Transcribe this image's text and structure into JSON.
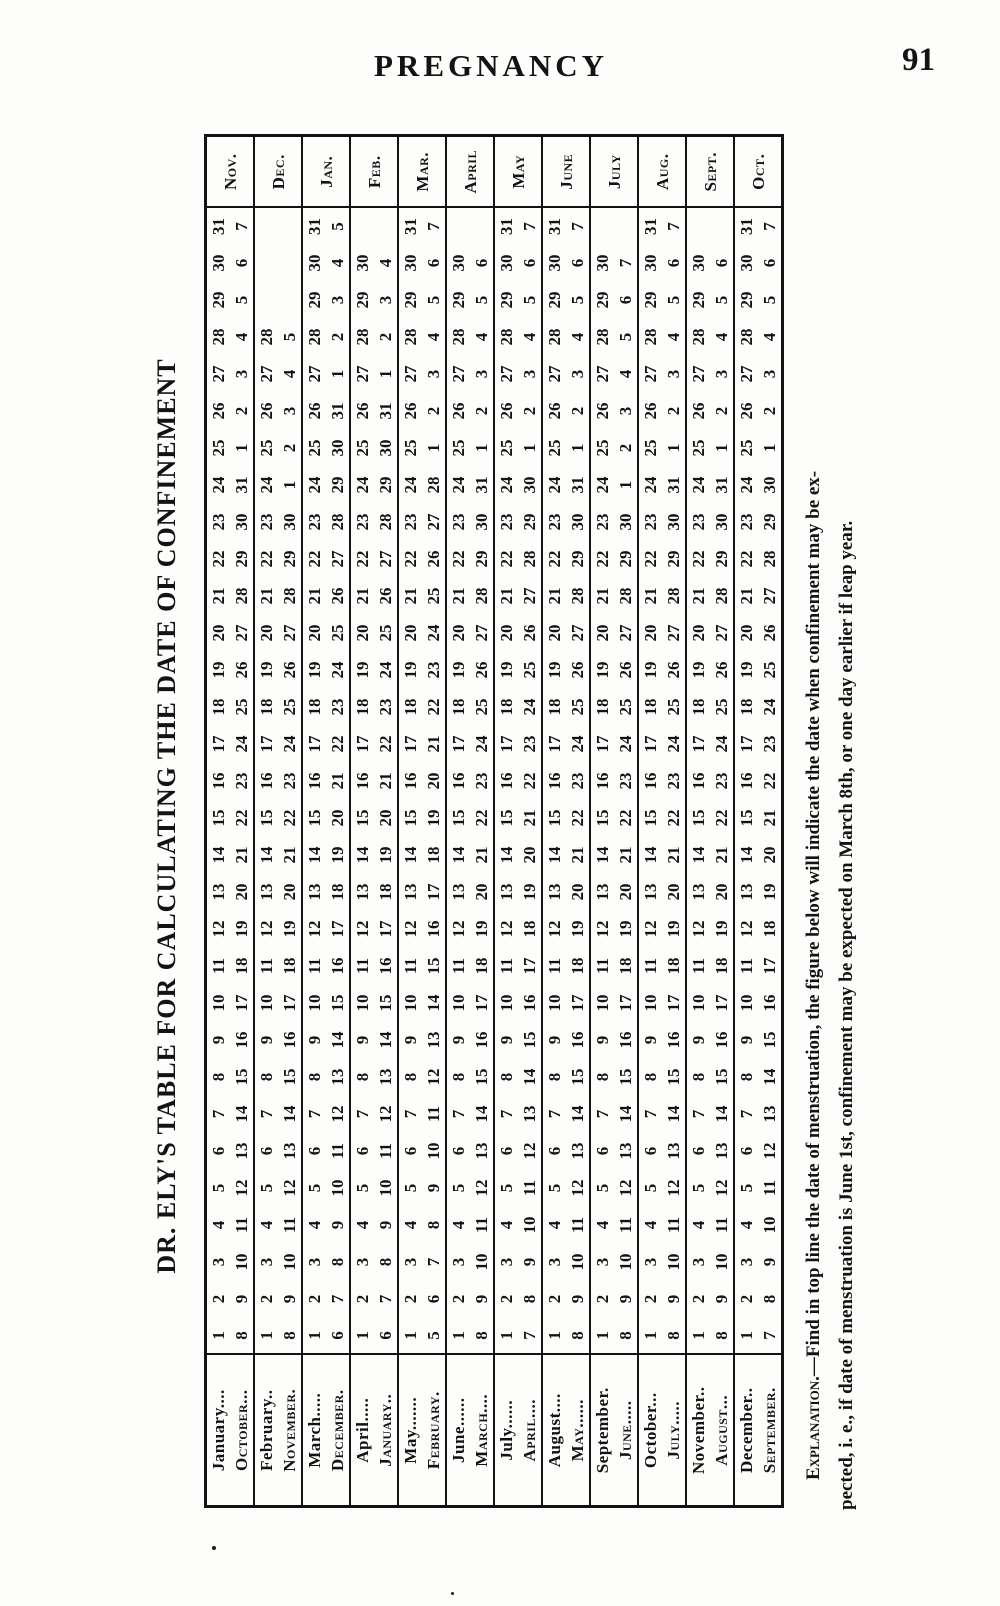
{
  "page": {
    "header_title": "PREGNANCY",
    "page_number": "91"
  },
  "colors": {
    "ink": "#131313",
    "paper": "#fdfdfb"
  },
  "table": {
    "title": "DR. ELY'S TABLE FOR CALCULATING THE DATE OF CONFINEMENT",
    "rows": [
      {
        "menses_month": "January....",
        "confine_month": "October...",
        "overflow_label": "Nov.",
        "menses_days": [
          1,
          2,
          3,
          4,
          5,
          6,
          7,
          8,
          9,
          10,
          11,
          12,
          13,
          14,
          15,
          16,
          17,
          18,
          19,
          20,
          21,
          22,
          23,
          24,
          25,
          26,
          27,
          28,
          29,
          30,
          31
        ],
        "confine_dates": [
          8,
          9,
          10,
          11,
          12,
          13,
          14,
          15,
          16,
          17,
          18,
          19,
          20,
          21,
          22,
          23,
          24,
          25,
          26,
          27,
          28,
          29,
          30,
          31,
          1,
          2,
          3,
          4,
          5,
          6,
          7
        ]
      },
      {
        "menses_month": "February..",
        "confine_month": "November.",
        "overflow_label": "Dec.",
        "menses_days": [
          1,
          2,
          3,
          4,
          5,
          6,
          7,
          8,
          9,
          10,
          11,
          12,
          13,
          14,
          15,
          16,
          17,
          18,
          19,
          20,
          21,
          22,
          23,
          24,
          25,
          26,
          27,
          28
        ],
        "confine_dates": [
          8,
          9,
          10,
          11,
          12,
          13,
          14,
          15,
          16,
          17,
          18,
          19,
          20,
          21,
          22,
          23,
          24,
          25,
          26,
          27,
          28,
          29,
          30,
          1,
          2,
          3,
          4,
          5
        ]
      },
      {
        "menses_month": "March.....",
        "confine_month": "December.",
        "overflow_label": "Jan.",
        "menses_days": [
          1,
          2,
          3,
          4,
          5,
          6,
          7,
          8,
          9,
          10,
          11,
          12,
          13,
          14,
          15,
          16,
          17,
          18,
          19,
          20,
          21,
          22,
          23,
          24,
          25,
          26,
          27,
          28,
          29,
          30,
          31
        ],
        "confine_dates": [
          6,
          7,
          8,
          9,
          10,
          11,
          12,
          13,
          14,
          15,
          16,
          17,
          18,
          19,
          20,
          21,
          22,
          23,
          24,
          25,
          26,
          27,
          28,
          29,
          30,
          31,
          1,
          2,
          3,
          4,
          5
        ]
      },
      {
        "menses_month": "April.....",
        "confine_month": "January..",
        "overflow_label": "Feb.",
        "menses_days": [
          1,
          2,
          3,
          4,
          5,
          6,
          7,
          8,
          9,
          10,
          11,
          12,
          13,
          14,
          15,
          16,
          17,
          18,
          19,
          20,
          21,
          22,
          23,
          24,
          25,
          26,
          27,
          28,
          29,
          30
        ],
        "confine_dates": [
          6,
          7,
          8,
          9,
          10,
          11,
          12,
          13,
          14,
          15,
          16,
          17,
          18,
          19,
          20,
          21,
          22,
          23,
          24,
          25,
          26,
          27,
          28,
          29,
          30,
          31,
          1,
          2,
          3,
          4
        ]
      },
      {
        "menses_month": "May.......",
        "confine_month": "February.",
        "overflow_label": "Mar.",
        "menses_days": [
          1,
          2,
          3,
          4,
          5,
          6,
          7,
          8,
          9,
          10,
          11,
          12,
          13,
          14,
          15,
          16,
          17,
          18,
          19,
          20,
          21,
          22,
          23,
          24,
          25,
          26,
          27,
          28,
          29,
          30,
          31
        ],
        "confine_dates": [
          5,
          6,
          7,
          8,
          9,
          10,
          11,
          12,
          13,
          14,
          15,
          16,
          17,
          18,
          19,
          20,
          21,
          22,
          23,
          24,
          25,
          26,
          27,
          28,
          1,
          2,
          3,
          4,
          5,
          6,
          7
        ]
      },
      {
        "menses_month": "June......",
        "confine_month": "March....",
        "overflow_label": "April",
        "menses_days": [
          1,
          2,
          3,
          4,
          5,
          6,
          7,
          8,
          9,
          10,
          11,
          12,
          13,
          14,
          15,
          16,
          17,
          18,
          19,
          20,
          21,
          22,
          23,
          24,
          25,
          26,
          27,
          28,
          29,
          30
        ],
        "confine_dates": [
          8,
          9,
          10,
          11,
          12,
          13,
          14,
          15,
          16,
          17,
          18,
          19,
          20,
          21,
          22,
          23,
          24,
          25,
          26,
          27,
          28,
          29,
          30,
          31,
          1,
          2,
          3,
          4,
          5,
          6
        ]
      },
      {
        "menses_month": "July......",
        "confine_month": "April....",
        "overflow_label": "May",
        "menses_days": [
          1,
          2,
          3,
          4,
          5,
          6,
          7,
          8,
          9,
          10,
          11,
          12,
          13,
          14,
          15,
          16,
          17,
          18,
          19,
          20,
          21,
          22,
          23,
          24,
          25,
          26,
          27,
          28,
          29,
          30,
          31
        ],
        "confine_dates": [
          7,
          8,
          9,
          10,
          11,
          12,
          13,
          14,
          15,
          16,
          17,
          18,
          19,
          20,
          21,
          22,
          23,
          24,
          25,
          26,
          27,
          28,
          29,
          30,
          1,
          2,
          3,
          4,
          5,
          6,
          7
        ]
      },
      {
        "menses_month": "August....",
        "confine_month": "May......",
        "overflow_label": "June",
        "menses_days": [
          1,
          2,
          3,
          4,
          5,
          6,
          7,
          8,
          9,
          10,
          11,
          12,
          13,
          14,
          15,
          16,
          17,
          18,
          19,
          20,
          21,
          22,
          23,
          24,
          25,
          26,
          27,
          28,
          29,
          30,
          31
        ],
        "confine_dates": [
          8,
          9,
          10,
          11,
          12,
          13,
          14,
          15,
          16,
          17,
          18,
          19,
          20,
          21,
          22,
          23,
          24,
          25,
          26,
          27,
          28,
          29,
          30,
          31,
          1,
          2,
          3,
          4,
          5,
          6,
          7
        ]
      },
      {
        "menses_month": "September.",
        "confine_month": "June.....",
        "overflow_label": "July",
        "menses_days": [
          1,
          2,
          3,
          4,
          5,
          6,
          7,
          8,
          9,
          10,
          11,
          12,
          13,
          14,
          15,
          16,
          17,
          18,
          19,
          20,
          21,
          22,
          23,
          24,
          25,
          26,
          27,
          28,
          29,
          30
        ],
        "confine_dates": [
          8,
          9,
          10,
          11,
          12,
          13,
          14,
          15,
          16,
          17,
          18,
          19,
          20,
          21,
          22,
          23,
          24,
          25,
          26,
          27,
          28,
          29,
          30,
          1,
          2,
          3,
          4,
          5,
          6,
          7
        ]
      },
      {
        "menses_month": "October...",
        "confine_month": "July.....",
        "overflow_label": "Aug.",
        "menses_days": [
          1,
          2,
          3,
          4,
          5,
          6,
          7,
          8,
          9,
          10,
          11,
          12,
          13,
          14,
          15,
          16,
          17,
          18,
          19,
          20,
          21,
          22,
          23,
          24,
          25,
          26,
          27,
          28,
          29,
          30,
          31
        ],
        "confine_dates": [
          8,
          9,
          10,
          11,
          12,
          13,
          14,
          15,
          16,
          17,
          18,
          19,
          20,
          21,
          22,
          23,
          24,
          25,
          26,
          27,
          28,
          29,
          30,
          31,
          1,
          2,
          3,
          4,
          5,
          6,
          7
        ]
      },
      {
        "menses_month": "November..",
        "confine_month": "August...",
        "overflow_label": "Sept.",
        "menses_days": [
          1,
          2,
          3,
          4,
          5,
          6,
          7,
          8,
          9,
          10,
          11,
          12,
          13,
          14,
          15,
          16,
          17,
          18,
          19,
          20,
          21,
          22,
          23,
          24,
          25,
          26,
          27,
          28,
          29,
          30
        ],
        "confine_dates": [
          8,
          9,
          10,
          11,
          12,
          13,
          14,
          15,
          16,
          17,
          18,
          19,
          20,
          21,
          22,
          23,
          24,
          25,
          26,
          27,
          28,
          29,
          30,
          31,
          1,
          2,
          3,
          4,
          5,
          6
        ]
      },
      {
        "menses_month": "December..",
        "confine_month": "September.",
        "overflow_label": "Oct.",
        "menses_days": [
          1,
          2,
          3,
          4,
          5,
          6,
          7,
          8,
          9,
          10,
          11,
          12,
          13,
          14,
          15,
          16,
          17,
          18,
          19,
          20,
          21,
          22,
          23,
          24,
          25,
          26,
          27,
          28,
          29,
          30,
          31
        ],
        "confine_dates": [
          7,
          8,
          9,
          10,
          11,
          12,
          13,
          14,
          15,
          16,
          17,
          18,
          19,
          20,
          21,
          22,
          23,
          24,
          25,
          26,
          27,
          28,
          29,
          30,
          1,
          2,
          3,
          4,
          5,
          6,
          7
        ]
      }
    ],
    "explanation_label": "Explanation.",
    "explanation_line1_rest": "—Find in top line the date of menstruation, the figure below will indicate the date when confinement may be ex-",
    "explanation_line2": "pected, i. e., if date of menstruation is June 1st, confinement may be expected on March 8th, or one day earlier if leap year."
  }
}
